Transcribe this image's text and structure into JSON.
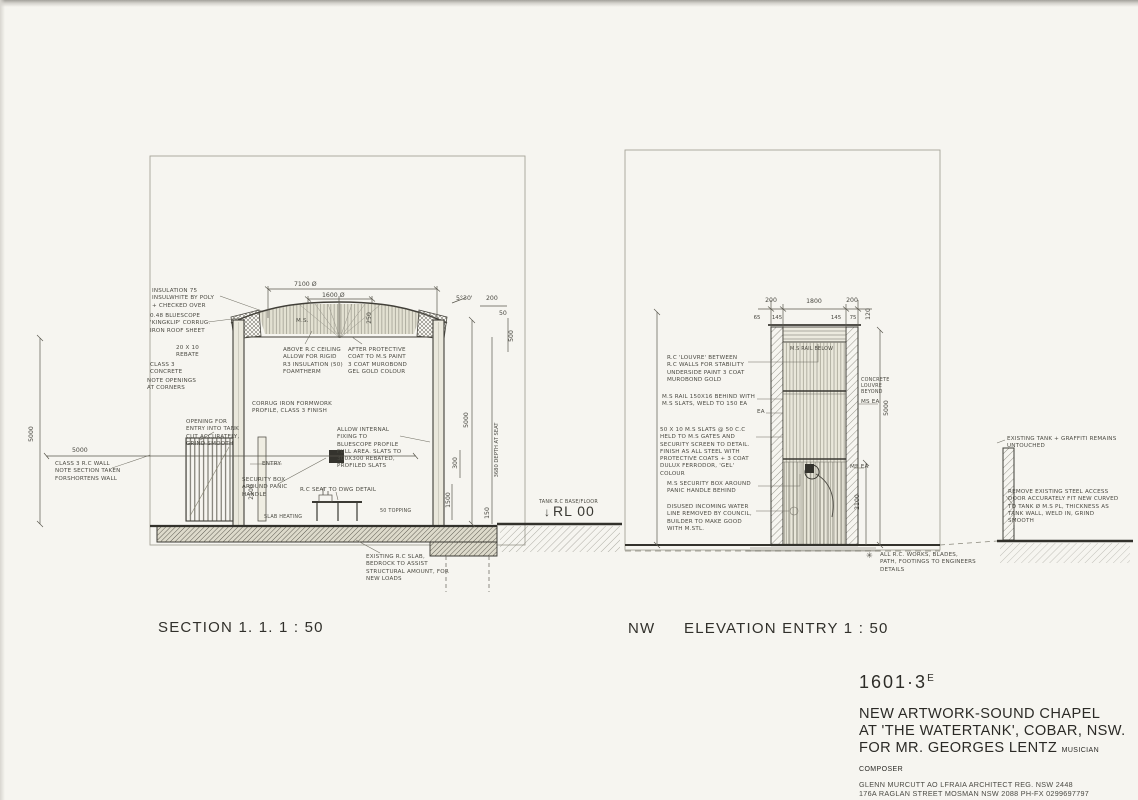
{
  "labels": {
    "section": "SECTION 1. 1. 1 : 50",
    "nw": "NW",
    "elevation": "ELEVATION ENTRY 1 : 50"
  },
  "section": {
    "notes": {
      "insulation": "INSULATION 75 INSULWHITE BY POLY + CHECKED OVER",
      "roof_sheet": "0.48 BLUESCOPE 'KINGKLIP' CORRUG. IRON ROOF SHEET",
      "rebate": "20 X 10 REBATE",
      "concrete": "CLASS 3 CONCRETE",
      "corners": "NOTE OPENINGS AT CORNERS",
      "ms": "M.S.",
      "ceiling": "ABOVE R.C CEILING ALLOW FOR RIGID R3 INSULATION (50) FOAMTHERM",
      "protective": "AFTER PROTECTIVE COAT TO M.S PAINT 3 COAT MUROBOND GEL GOLD COLOUR",
      "formwork": "CORRUG IRON FORMWORK PROFILE, CLASS 3 FINISH",
      "internal_fixing": "ALLOW INTERNAL FIXING TO BLUESCOPE PROFILE FULL AREA. SLATS TO 300X300 REBATED, PROFILED SLATS",
      "opening": "OPENING FOR ENTRY INTO TANK CUT ACCURATELY, GRIND SMOOTH",
      "wall": "CLASS 3 R.C WALL NOTE SECTION TAKEN FORSHORTENS WALL",
      "entry": "ENTRY",
      "security_box": "SECURITY BOX AROUND PANIC HANDLE",
      "seat": "R.C SEAT TO DWG DETAIL",
      "topping": "50 TOPPING",
      "slab_heating": "SLAB HEATING",
      "existing_slab": "EXISTING R.C SLAB, BEDROCK TO ASSIST STRUCTURAL AMOUNT, FOR NEW LOADS",
      "tank_base": "TANK R.C BASE/FLOOR",
      "rl_arrow": "↓",
      "rl": "RL 00"
    },
    "dims": {
      "d_7100": "7100 Ø",
      "d_1600": "1600 Ø",
      "d_250": "250",
      "d_angle": "5°30'",
      "d_200": "200",
      "d_50": "50",
      "d_500": "500",
      "d_5000_left": "5000",
      "d_5000_w": "5000",
      "d_5000_int": "5000",
      "d_depth": "3680 DEPTH AT SEAT",
      "d_300": "300",
      "d_1500": "1500",
      "d_150": "150",
      "d_2100": "2100"
    }
  },
  "elevation": {
    "notes": {
      "louvre": "R.C 'LOUVRE' BETWEEN R.C WALLS FOR STABILITY UNDERSIDE PAINT 3 COAT MUROBOND GOLD",
      "rail": "M.S RAIL 150X16 BEHIND WITH M.S SLATS, WELD TO 150 EA",
      "ea": "EA",
      "slats": "50 X 10 M.S SLATS @ 50 C.C HELD TO M.S GATES AND SECURITY SCREEN TO DETAIL. FINISH AS ALL STEEL WITH PROTECTIVE COATS + 3 COAT DULUX FERRODOR, 'GEL' COLOUR",
      "security": "M.S SECURITY BOX AROUND PANIC HANDLE BEHIND",
      "water_line": "DISUSED INCOMING WATER LINE REMOVED BY COUNCIL, BUILDER TO MAKE GOOD WITH M.STL.",
      "rail_below": "M.S RAIL BELOW",
      "louvre_beyond": "CONCRETE LOUVRE BEYOND",
      "ms_ea_1": "MS EA",
      "ms_ea_2": "MS EA",
      "graffiti": "EXISTING TANK + GRAFFITI REMAINS UNTOUCHED",
      "access_door": "REMOVE EXISTING STEEL ACCESS DOOR ACCURATELY FIT NEW CURVED TO TANK Ø M.S PL, THICKNESS AS TANK WALL, WELD IN, GRIND SMOOTH",
      "engineer_mark": "✳",
      "engineer": "ALL R.C. WORKS, BLADES, PATH, FOOTINGS TO ENGINEERS DETAILS"
    },
    "dims": {
      "d_200_l": "200",
      "d_1800": "1800",
      "d_200_r": "200",
      "d_65": "65",
      "d_145_l": "145",
      "d_145_r": "145",
      "d_75": "75",
      "d_120": "120",
      "d_5000": "5000",
      "d_2100": "2100"
    }
  },
  "titleblock": {
    "number": "1601·3",
    "revision": "E",
    "title_line1": "NEW ARTWORK-SOUND CHAPEL",
    "title_line2": "AT 'THE WATERTANK', COBAR, NSW.",
    "title_line3": "FOR MR. GEORGES LENTZ",
    "title_suffix": "MUSICIAN COMPOSER",
    "credit_line1": "GLENN MURCUTT AO LFRAIA ARCHITECT  REG. NSW 2448",
    "credit_line2": "176A RAGLAN STREET MOSMAN NSW 2088  PH-FX 0299697797",
    "scale": "SCALE 1:50",
    "date": "18TH OCTOBER, 2017"
  },
  "colors": {
    "paper": "#f6f5f0",
    "ink": "#3c3b35",
    "pencil": "#6f6d62"
  }
}
